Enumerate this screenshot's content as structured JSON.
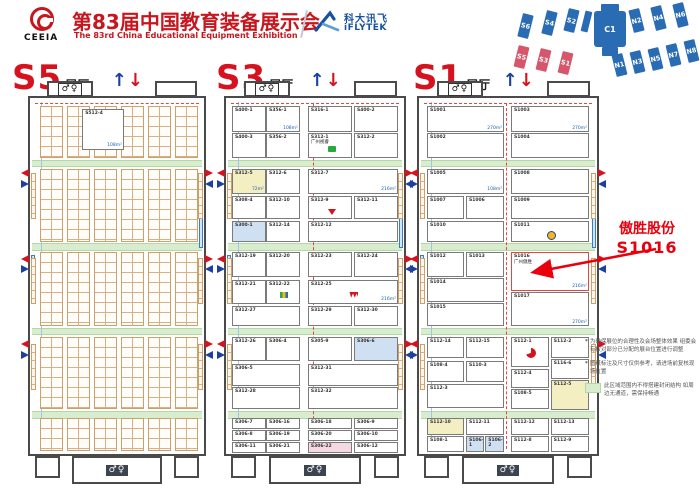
{
  "header": {
    "org_abbr": "CEEIA",
    "title_zh": "第83届中国教育装备展示会",
    "title_en": "The 83rd China Educational Equipment Exhibition",
    "sponsor_zh": "科大讯飞",
    "sponsor_en": "iFLYTEK",
    "accent_red": "#c8161e",
    "accent_blue": "#17519f"
  },
  "icons": {
    "restroom": "♂♀",
    "arrow_up": "↑",
    "arrow_down": "↓"
  },
  "annotation": {
    "company": "傲胜股份",
    "booth": "S1016",
    "color": "#e8000d"
  },
  "notes": [
    {
      "bullet": "*",
      "text": "为确保展位的合理性及会场整体效果 组委会有权对部分已分配的展台位置进行调整"
    },
    {
      "bullet": "*",
      "text": "图纸标注及尺寸仅供参考，请进场前复核现场位置"
    }
  ],
  "legend": {
    "swatch_color": "#d8ecce",
    "text": "此区域范围内不得搭建封闭结构 如周边无通道，需保持畅通"
  },
  "overview": {
    "base_color": "#2a6cb3",
    "highlight_color": "#d6576b",
    "blocks": [
      {
        "t": "S6",
        "x": 18,
        "y": 12,
        "w": 11,
        "h": 24,
        "r": 14,
        "c": "b"
      },
      {
        "t": "S4",
        "x": 42,
        "y": 9,
        "w": 11,
        "h": 24,
        "r": 14,
        "c": "b"
      },
      {
        "t": "S2",
        "x": 64,
        "y": 7,
        "w": 11,
        "h": 23,
        "r": 14,
        "c": "b"
      },
      {
        "t": "",
        "x": 81,
        "y": 9,
        "w": 7,
        "h": 21,
        "r": 14,
        "c": "b"
      },
      {
        "t": "",
        "x": 99,
        "y": 2,
        "w": 18,
        "h": 8,
        "r": 0,
        "c": "b"
      },
      {
        "t": "C1",
        "x": 92,
        "y": 9,
        "w": 32,
        "h": 36,
        "r": 0,
        "c": "b",
        "big": true
      },
      {
        "t": "",
        "x": 100,
        "y": 45,
        "w": 16,
        "h": 9,
        "r": 0,
        "c": "b"
      },
      {
        "t": "N2",
        "x": 129,
        "y": 7,
        "w": 11,
        "h": 23,
        "r": -14,
        "c": "b"
      },
      {
        "t": "N4",
        "x": 151,
        "y": 4,
        "w": 11,
        "h": 24,
        "r": -14,
        "c": "b"
      },
      {
        "t": "N6",
        "x": 173,
        "y": 1,
        "w": 11,
        "h": 24,
        "r": -14,
        "c": "b"
      },
      {
        "t": "S5",
        "x": 14,
        "y": 44,
        "w": 11,
        "h": 22,
        "r": 14,
        "c": "r"
      },
      {
        "t": "S3",
        "x": 36,
        "y": 47,
        "w": 11,
        "h": 22,
        "r": 14,
        "c": "r"
      },
      {
        "t": "S1",
        "x": 58,
        "y": 50,
        "w": 11,
        "h": 22,
        "r": 14,
        "c": "r"
      },
      {
        "t": "N1",
        "x": 112,
        "y": 52,
        "w": 11,
        "h": 22,
        "r": -14,
        "c": "b"
      },
      {
        "t": "N3",
        "x": 130,
        "y": 49,
        "w": 11,
        "h": 22,
        "r": -14,
        "c": "b"
      },
      {
        "t": "N5",
        "x": 148,
        "y": 46,
        "w": 11,
        "h": 22,
        "r": -14,
        "c": "b"
      },
      {
        "t": "N7",
        "x": 166,
        "y": 42,
        "w": 11,
        "h": 22,
        "r": -14,
        "c": "b"
      },
      {
        "t": "N8",
        "x": 184,
        "y": 38,
        "w": 11,
        "h": 22,
        "r": -14,
        "c": "b"
      }
    ]
  },
  "halls": [
    {
      "name": "S5",
      "suffix": "展厅",
      "booths": [
        {
          "i": "S512-4",
          "x": 30,
          "y": 3,
          "w": 24,
          "h": 11.5,
          "s": "108m²"
        }
      ],
      "grid_groups": {
        "xs": [
          6,
          21.5,
          37,
          52.5,
          68,
          83.5
        ],
        "w": 13,
        "sections": [
          [
            2.3,
            14.5
          ],
          [
            19.9,
            20.5
          ],
          [
            43.3,
            20.8
          ],
          [
            67,
            20.5
          ],
          [
            90,
            9.3
          ]
        ]
      },
      "center_dash": false
    },
    {
      "name": "S3",
      "suffix": "展厅",
      "center_dash": true,
      "booths": [
        {
          "i": "S400-1",
          "x": 3.4,
          "y": 2.3,
          "w": 19,
          "h": 7.3
        },
        {
          "i": "S356-1",
          "x": 22.5,
          "y": 2.3,
          "w": 19,
          "h": 7.3,
          "s": "108m²"
        },
        {
          "i": "S400-3",
          "x": 3.4,
          "y": 9.8,
          "w": 19,
          "h": 7
        },
        {
          "i": "S356-2",
          "x": 22.5,
          "y": 9.8,
          "w": 19,
          "h": 7
        },
        {
          "i": "S316-1",
          "x": 46,
          "y": 2.3,
          "w": 24.8,
          "h": 7.3
        },
        {
          "i": "S400-2",
          "x": 71.9,
          "y": 2.3,
          "w": 24.7,
          "h": 7.3
        },
        {
          "i": "S312-1",
          "n": "广州视睿",
          "x": 46,
          "y": 9.8,
          "w": 24.8,
          "h": 7,
          "l": "seewo"
        },
        {
          "i": "S312-2",
          "x": 71.9,
          "y": 9.8,
          "w": 24.7,
          "h": 7
        },
        {
          "i": "S312-5",
          "x": 3.4,
          "y": 19.9,
          "w": 19,
          "h": 7,
          "f": "y",
          "s": "72m²"
        },
        {
          "i": "S312-6",
          "x": 22.5,
          "y": 19.9,
          "w": 19,
          "h": 7
        },
        {
          "i": "S312-7",
          "x": 46,
          "y": 19.9,
          "w": 50.6,
          "h": 7,
          "s": "216m²"
        },
        {
          "i": "S308-4",
          "x": 3.4,
          "y": 27.6,
          "w": 19,
          "h": 6.5
        },
        {
          "i": "S312-10",
          "x": 22.5,
          "y": 27.6,
          "w": 19,
          "h": 6.5
        },
        {
          "i": "S312-9",
          "x": 46,
          "y": 27.6,
          "w": 24.8,
          "h": 6.5,
          "l": "v"
        },
        {
          "i": "S312-11",
          "x": 71.9,
          "y": 27.6,
          "w": 24.7,
          "h": 6.5
        },
        {
          "i": "S300-1",
          "x": 3.4,
          "y": 34.6,
          "w": 19,
          "h": 5.8,
          "f": "b"
        },
        {
          "i": "S312-14",
          "x": 22.5,
          "y": 34.6,
          "w": 19,
          "h": 5.8
        },
        {
          "i": "S312-12",
          "x": 46,
          "y": 34.6,
          "w": 50.6,
          "h": 5.8
        },
        {
          "i": "S312-19",
          "x": 3.4,
          "y": 43.3,
          "w": 19,
          "h": 7
        },
        {
          "i": "S312-20",
          "x": 22.5,
          "y": 43.3,
          "w": 19,
          "h": 7
        },
        {
          "i": "S312-23",
          "x": 46,
          "y": 43.3,
          "w": 24.8,
          "h": 7
        },
        {
          "i": "S312-24",
          "x": 71.9,
          "y": 43.3,
          "w": 24.7,
          "h": 7
        },
        {
          "i": "S312-21",
          "x": 3.4,
          "y": 51,
          "w": 19,
          "h": 6.8
        },
        {
          "i": "S312-22",
          "x": 22.5,
          "y": 51,
          "w": 19,
          "h": 6.8,
          "l": "m"
        },
        {
          "i": "S312-25",
          "x": 46,
          "y": 51,
          "w": 50.6,
          "h": 6.8,
          "l": "w",
          "s": "216m²"
        },
        {
          "i": "S312-27",
          "x": 3.4,
          "y": 58.3,
          "w": 38.1,
          "h": 5.8
        },
        {
          "i": "S312-29",
          "x": 46,
          "y": 58.3,
          "w": 24.8,
          "h": 5.8
        },
        {
          "i": "S312-30",
          "x": 71.9,
          "y": 58.3,
          "w": 24.7,
          "h": 5.8
        },
        {
          "i": "S312-26",
          "x": 3.4,
          "y": 67,
          "w": 19,
          "h": 7
        },
        {
          "i": "S306-4",
          "x": 22.5,
          "y": 67,
          "w": 19,
          "h": 7
        },
        {
          "i": "S305-9",
          "x": 46,
          "y": 67,
          "w": 24.8,
          "h": 7
        },
        {
          "i": "S306-6",
          "x": 71.9,
          "y": 67,
          "w": 24.7,
          "h": 7,
          "f": "b"
        },
        {
          "i": "S306-5",
          "x": 3.4,
          "y": 74.6,
          "w": 38.1,
          "h": 6.2
        },
        {
          "i": "S312-31",
          "x": 46,
          "y": 74.6,
          "w": 50.6,
          "h": 6.2
        },
        {
          "i": "S312-28",
          "x": 3.4,
          "y": 81.3,
          "w": 38.1,
          "h": 6
        },
        {
          "i": "S312-32",
          "x": 46,
          "y": 81.3,
          "w": 50.6,
          "h": 6
        },
        {
          "i": "S306-7",
          "x": 3.4,
          "y": 90,
          "w": 19,
          "h": 3.1
        },
        {
          "i": "S306-16",
          "x": 22.5,
          "y": 90,
          "w": 19,
          "h": 3.1
        },
        {
          "i": "S306-18",
          "x": 46,
          "y": 90,
          "w": 24.8,
          "h": 3.1
        },
        {
          "i": "S306-9",
          "x": 71.9,
          "y": 90,
          "w": 24.7,
          "h": 3.1
        },
        {
          "i": "S306-8",
          "x": 3.4,
          "y": 93.3,
          "w": 19,
          "h": 3.1
        },
        {
          "i": "S306-19",
          "x": 22.5,
          "y": 93.3,
          "w": 19,
          "h": 3.1
        },
        {
          "i": "S306-20",
          "x": 46,
          "y": 93.3,
          "w": 24.8,
          "h": 3.1
        },
        {
          "i": "S306-10",
          "x": 71.9,
          "y": 93.3,
          "w": 24.7,
          "h": 3.1
        },
        {
          "i": "S306-11",
          "x": 3.4,
          "y": 96.6,
          "w": 19,
          "h": 3.1
        },
        {
          "i": "S306-21",
          "x": 22.5,
          "y": 96.6,
          "w": 19,
          "h": 3.1
        },
        {
          "i": "S306-22",
          "x": 46,
          "y": 96.6,
          "w": 24.8,
          "h": 3.1,
          "f": "p"
        },
        {
          "i": "S306-12",
          "x": 71.9,
          "y": 96.6,
          "w": 24.7,
          "h": 3.1
        }
      ]
    },
    {
      "name": "S1",
      "suffix": "展厅",
      "center_dash": true,
      "booths": [
        {
          "i": "S1001",
          "x": 4.5,
          "y": 2.3,
          "w": 43.3,
          "h": 7.3,
          "s": "270m²"
        },
        {
          "i": "S1003",
          "x": 51.7,
          "y": 2.3,
          "w": 43.8,
          "h": 7.3,
          "s": "270m²"
        },
        {
          "i": "S1002",
          "x": 4.5,
          "y": 9.8,
          "w": 43.3,
          "h": 7
        },
        {
          "i": "S1004",
          "x": 51.7,
          "y": 9.8,
          "w": 43.8,
          "h": 7
        },
        {
          "i": "S1005",
          "x": 4.5,
          "y": 19.9,
          "w": 43.3,
          "h": 7,
          "s": "108m²"
        },
        {
          "i": "S1008",
          "x": 51.7,
          "y": 19.9,
          "w": 43.8,
          "h": 7
        },
        {
          "i": "S1007",
          "x": 4.5,
          "y": 27.6,
          "w": 20.8,
          "h": 6.5
        },
        {
          "i": "S1006",
          "x": 26.4,
          "y": 27.6,
          "w": 21.4,
          "h": 6.5
        },
        {
          "i": "S1009",
          "x": 51.7,
          "y": 27.6,
          "w": 43.8,
          "h": 6.5
        },
        {
          "i": "S1010",
          "x": 4.5,
          "y": 34.6,
          "w": 43.3,
          "h": 5.8
        },
        {
          "i": "S1011",
          "x": 51.7,
          "y": 34.6,
          "w": 43.8,
          "h": 5.8,
          "l": "c"
        },
        {
          "i": "S1012",
          "x": 4.5,
          "y": 43.3,
          "w": 20.8,
          "h": 7
        },
        {
          "i": "S1013",
          "x": 26.4,
          "y": 43.3,
          "w": 21.4,
          "h": 7
        },
        {
          "i": "S1016",
          "n": "广州傲胜",
          "x": 51.7,
          "y": 43.3,
          "w": 43.8,
          "h": 10.8,
          "s": "216m²",
          "hl": true
        },
        {
          "i": "S1014",
          "x": 4.5,
          "y": 50.6,
          "w": 43.3,
          "h": 6.6
        },
        {
          "i": "S1015",
          "x": 4.5,
          "y": 57.5,
          "w": 43.3,
          "h": 6.6
        },
        {
          "i": "S1017",
          "x": 51.7,
          "y": 54.4,
          "w": 43.8,
          "h": 9.7,
          "s": "270m²"
        },
        {
          "i": "S112-14",
          "x": 4.5,
          "y": 67,
          "w": 20.8,
          "h": 6
        },
        {
          "i": "S112-15",
          "x": 26.4,
          "y": 67,
          "w": 21.4,
          "h": 6
        },
        {
          "i": "S112-1",
          "x": 51.7,
          "y": 67,
          "w": 21.3,
          "h": 8.5,
          "l": "r"
        },
        {
          "i": "S112-2",
          "x": 74,
          "y": 67,
          "w": 21.5,
          "h": 6
        },
        {
          "i": "S108-4",
          "x": 4.5,
          "y": 74,
          "w": 20.8,
          "h": 5.8
        },
        {
          "i": "S110-3",
          "x": 26.4,
          "y": 74,
          "w": 21.4,
          "h": 5.8
        },
        {
          "i": "S116-6",
          "x": 74,
          "y": 73.3,
          "w": 21.5,
          "h": 5.5
        },
        {
          "i": "S112-3",
          "x": 4.5,
          "y": 80.2,
          "w": 43.3,
          "h": 7
        },
        {
          "i": "S112-4",
          "x": 51.7,
          "y": 76,
          "w": 21.3,
          "h": 5.5
        },
        {
          "i": "S112-5",
          "x": 74,
          "y": 79.1,
          "w": 21.5,
          "h": 8.5,
          "f": "y"
        },
        {
          "i": "S108-5",
          "x": 51.7,
          "y": 81.8,
          "w": 21.3,
          "h": 5.7
        },
        {
          "i": "S112-10",
          "x": 4.5,
          "y": 90,
          "w": 20.8,
          "h": 4.6,
          "f": "y"
        },
        {
          "i": "S112-11",
          "x": 26.4,
          "y": 90,
          "w": 21.4,
          "h": 4.6
        },
        {
          "i": "S112-12",
          "x": 51.7,
          "y": 90,
          "w": 21.3,
          "h": 4.6
        },
        {
          "i": "S112-13",
          "x": 74,
          "y": 90,
          "w": 21.5,
          "h": 4.6
        },
        {
          "i": "S108-1",
          "x": 4.5,
          "y": 94.9,
          "w": 20.8,
          "h": 4.6
        },
        {
          "i": "S106-1",
          "x": 26.4,
          "y": 94.9,
          "w": 10.2,
          "h": 4.6,
          "f": "b"
        },
        {
          "i": "S106-2",
          "x": 37.2,
          "y": 94.9,
          "w": 10.6,
          "h": 4.6,
          "f": "b"
        },
        {
          "i": "S112-8",
          "x": 51.7,
          "y": 94.9,
          "w": 21.3,
          "h": 4.6
        },
        {
          "i": "S112-9",
          "x": 74,
          "y": 94.9,
          "w": 21.5,
          "h": 4.6
        }
      ]
    }
  ]
}
